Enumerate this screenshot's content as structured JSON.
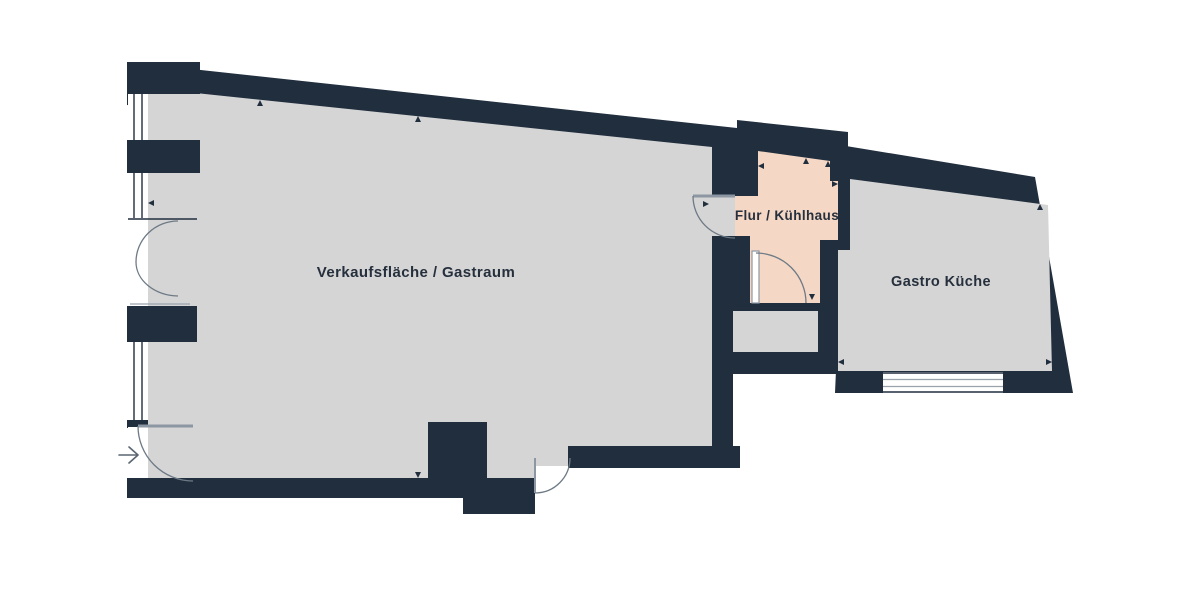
{
  "plan": {
    "title": "Floor plan",
    "rooms": [
      {
        "id": "verkaufsflaeche_gastraum",
        "label": "Verkaufsfläche / Gastraum",
        "fill": "#d5d5d5"
      },
      {
        "id": "flur_kuehlhaus",
        "label": "Flur / Kühlhaus",
        "fill": "#f4d8c5"
      },
      {
        "id": "gastro_kueche",
        "label": "Gastro Küche",
        "fill": "#d5d5d5"
      }
    ],
    "colors": {
      "background": "#ffffff",
      "wall": "#212e3e",
      "room_gray": "#d5d5d5",
      "room_peach": "#f4d8c5",
      "door_line": "#6e7a86",
      "label_text": "#26303d"
    }
  }
}
